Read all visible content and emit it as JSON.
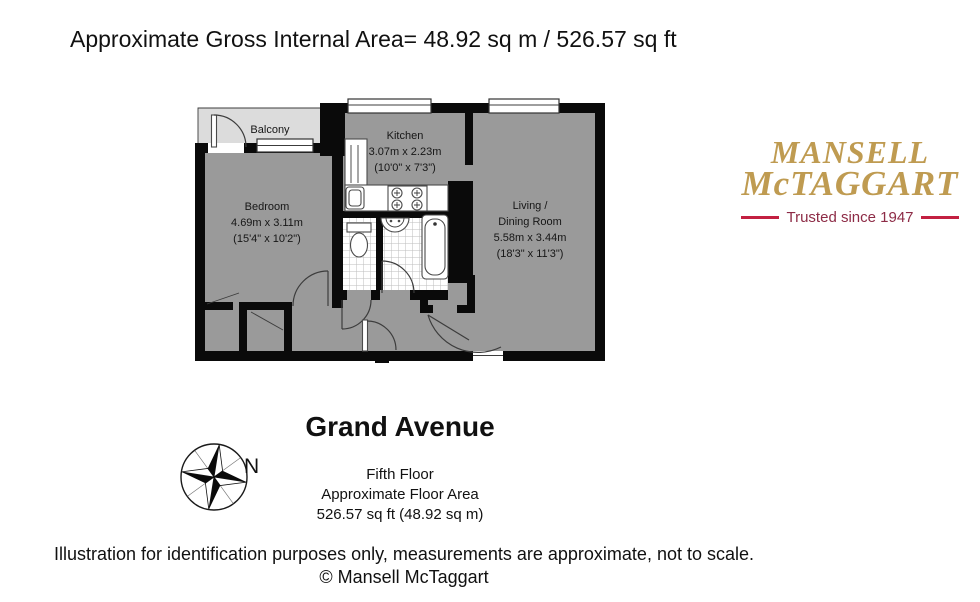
{
  "page": {
    "title_line": "Approximate Gross Internal Area= 48.92 sq m / 526.57 sq ft"
  },
  "logo": {
    "name_line1": "MANSELL",
    "name_line2": "McTAGGART",
    "tagline": "Trusted since 1947",
    "colors": {
      "gold": "#bf9b51",
      "maroon": "#8d2b46",
      "rule_red": "#c32041"
    }
  },
  "floorplan": {
    "rooms": [
      {
        "id": "balcony",
        "lines": [
          "Balcony"
        ]
      },
      {
        "id": "kitchen",
        "lines": [
          "Kitchen",
          "3.07m x 2.23m",
          "(10'0\" x 7'3\")"
        ]
      },
      {
        "id": "bedroom",
        "lines": [
          "Bedroom",
          "4.69m x 3.11m",
          "(15'4\" x 10'2\")"
        ]
      },
      {
        "id": "living_dining",
        "lines": [
          "Living /",
          "Dining Room",
          "5.58m x 3.44m",
          "(18'3\" x 11'3\")"
        ]
      }
    ],
    "colors": {
      "wall": "#0a0a0a",
      "room_fill": "#9a9a9a",
      "balcony_fill": "#dcdcdc"
    }
  },
  "compass": {
    "north_label": "N"
  },
  "property": {
    "name": "Grand Avenue",
    "floor": "Fifth Floor",
    "area_label": "Approximate Floor Area",
    "area_value": "526.57 sq ft (48.92 sq m)"
  },
  "footer": {
    "disclaimer": "Illustration for identification purposes only, measurements are approximate, not to scale.",
    "copyright": "© Mansell McTaggart"
  }
}
